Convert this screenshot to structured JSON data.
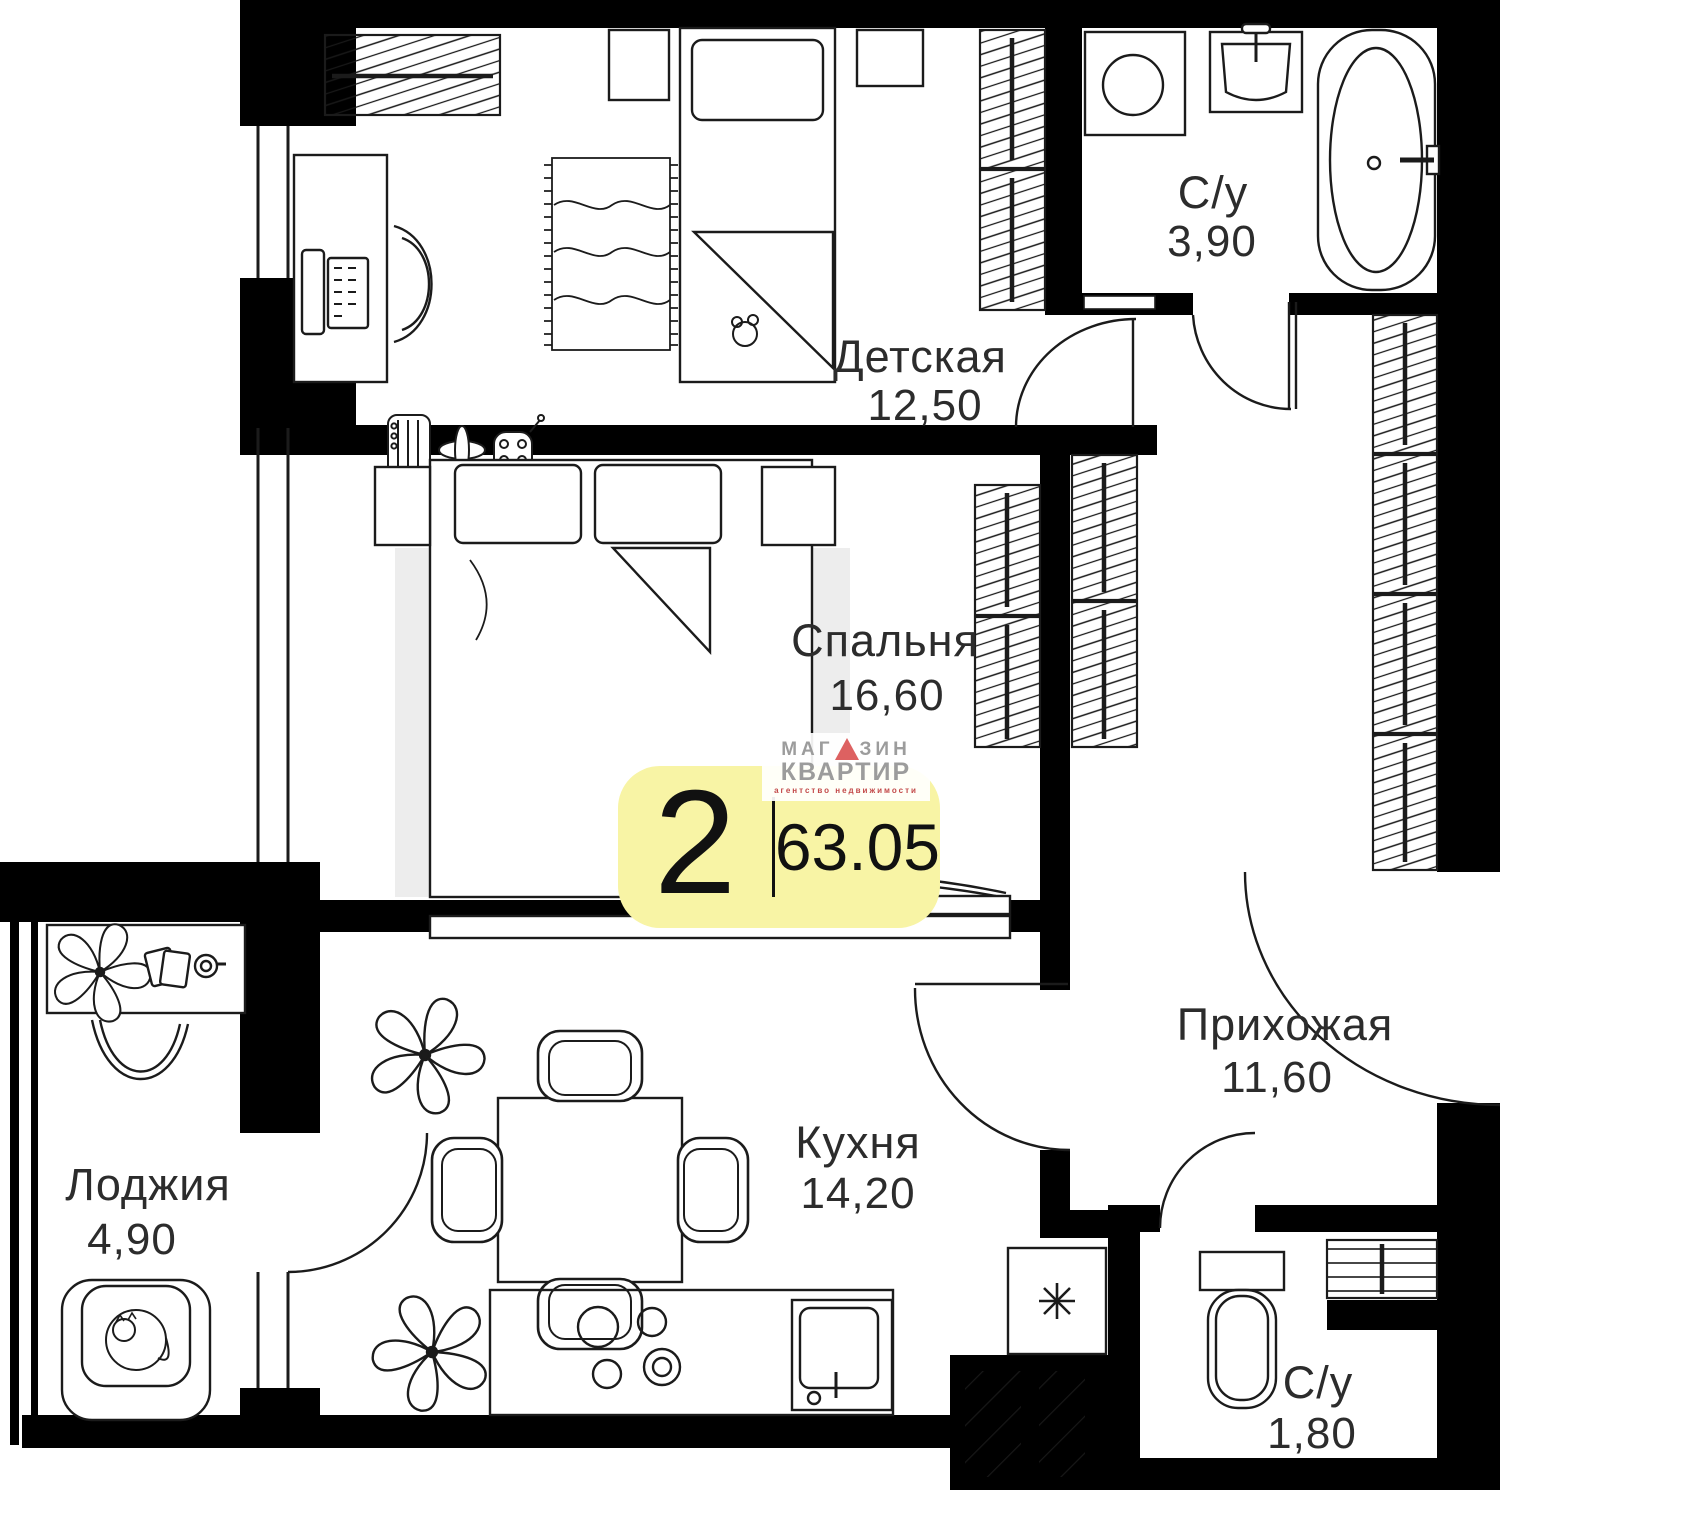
{
  "plan": {
    "title": "2-room apartment floor plan",
    "rooms": [
      {
        "name": "Детская",
        "area": "12,50"
      },
      {
        "name": "Спальня",
        "area": "16,60"
      },
      {
        "name": "С/у",
        "area": "3,90"
      },
      {
        "name": "Прихожая",
        "area": "11,60"
      },
      {
        "name": "Кухня",
        "area": "14,20"
      },
      {
        "name": "Лоджия",
        "area": "4,90"
      },
      {
        "name": "С/у",
        "area": "1,80"
      }
    ],
    "badge": {
      "rooms_count": "2",
      "total_area": "63.05"
    },
    "logo": {
      "word1_prefix": "МАГ",
      "word1_suffix": "ЗИН",
      "word2": "КВАРТИР",
      "tagline": "агентство недвижимости"
    },
    "colors": {
      "badge_bg": "#F8F4A5",
      "logo_red": "#DD6161",
      "logo_gray": "#9C9C9C",
      "tagline_red": "#C24848",
      "wall": "#000000",
      "carpet_gray": "#EDEDED"
    }
  }
}
